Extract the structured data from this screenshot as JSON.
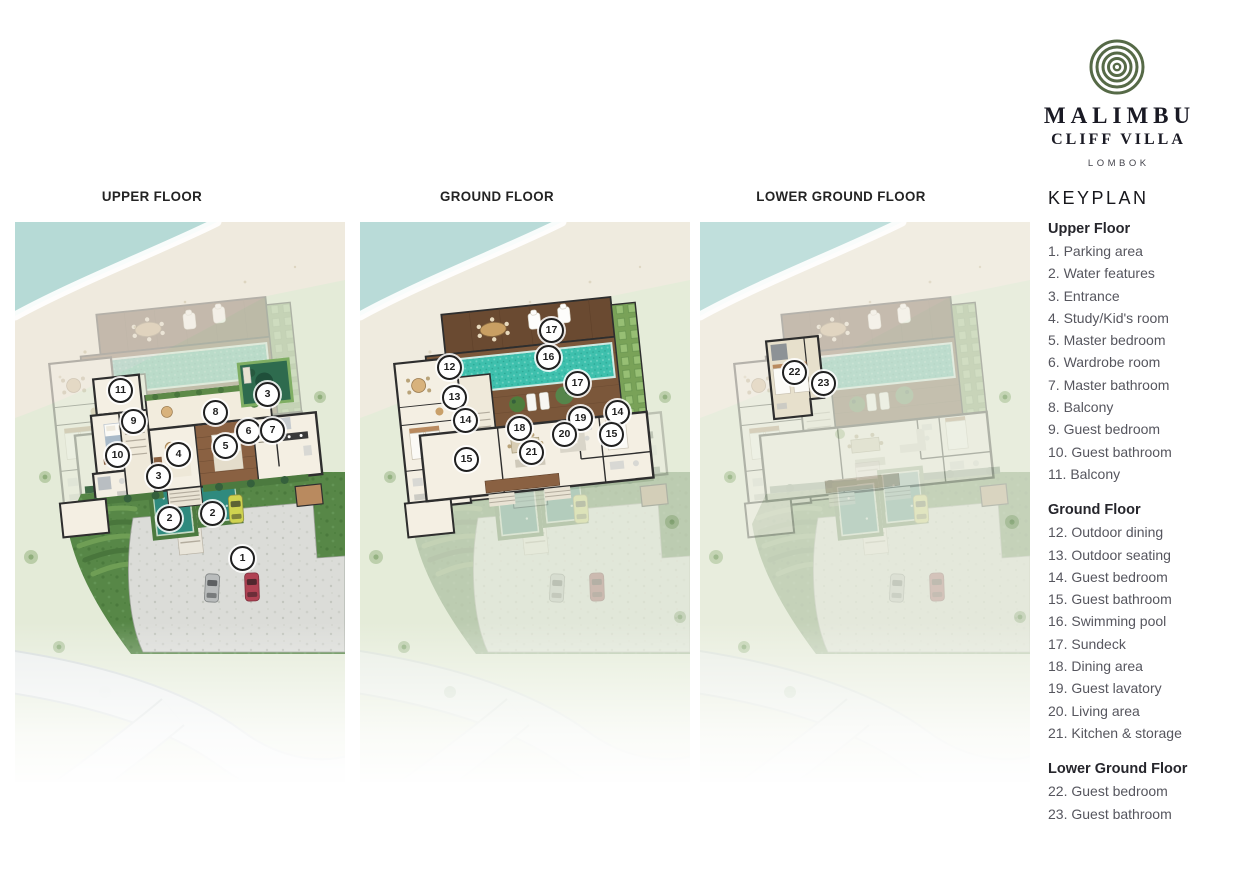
{
  "logo": {
    "name": "MALIMBU",
    "subtitle": "CLIFF VILLA",
    "location": "LOMBOK"
  },
  "panels": [
    {
      "id": "upper-floor",
      "title": "UPPER FLOOR",
      "markers": [
        {
          "number": "11",
          "x": 105,
          "y": 168
        },
        {
          "number": "9",
          "x": 118,
          "y": 199
        },
        {
          "number": "10",
          "x": 102,
          "y": 233
        },
        {
          "number": "3",
          "x": 143,
          "y": 254
        },
        {
          "number": "8",
          "x": 200,
          "y": 190
        },
        {
          "number": "3",
          "x": 252,
          "y": 172
        },
        {
          "number": "4",
          "x": 163,
          "y": 232
        },
        {
          "number": "5",
          "x": 210,
          "y": 224
        },
        {
          "number": "6",
          "x": 233,
          "y": 209
        },
        {
          "number": "7",
          "x": 257,
          "y": 208
        },
        {
          "number": "2",
          "x": 154,
          "y": 296
        },
        {
          "number": "2",
          "x": 197,
          "y": 291
        },
        {
          "number": "1",
          "x": 227,
          "y": 336
        }
      ]
    },
    {
      "id": "ground-floor",
      "title": "GROUND FLOOR",
      "markers": [
        {
          "number": "17",
          "x": 191,
          "y": 108
        },
        {
          "number": "16",
          "x": 188,
          "y": 135
        },
        {
          "number": "17",
          "x": 217,
          "y": 161
        },
        {
          "number": "12",
          "x": 89,
          "y": 145
        },
        {
          "number": "13",
          "x": 94,
          "y": 175
        },
        {
          "number": "14",
          "x": 105,
          "y": 198
        },
        {
          "number": "15",
          "x": 106,
          "y": 237
        },
        {
          "number": "18",
          "x": 159,
          "y": 206
        },
        {
          "number": "19",
          "x": 220,
          "y": 196
        },
        {
          "number": "20",
          "x": 204,
          "y": 212
        },
        {
          "number": "21",
          "x": 171,
          "y": 230
        },
        {
          "number": "14",
          "x": 257,
          "y": 190
        },
        {
          "number": "15",
          "x": 251,
          "y": 212
        }
      ]
    },
    {
      "id": "lower-ground-floor",
      "title": "LOWER GROUND FLOOR",
      "markers": [
        {
          "number": "22",
          "x": 94,
          "y": 150
        },
        {
          "number": "23",
          "x": 123,
          "y": 161
        }
      ]
    }
  ],
  "keyplan": {
    "title": "KEYPLAN",
    "sections": [
      {
        "heading": "Upper Floor",
        "items": [
          {
            "number": "1",
            "label": "Parking area"
          },
          {
            "number": "2",
            "label": "Water features"
          },
          {
            "number": "3",
            "label": "Entrance"
          },
          {
            "number": "4",
            "label": "Study/Kid's room"
          },
          {
            "number": "5",
            "label": "Master bedroom"
          },
          {
            "number": "6",
            "label": "Wardrobe room"
          },
          {
            "number": "7",
            "label": "Master bathroom"
          },
          {
            "number": "8",
            "label": "Balcony"
          },
          {
            "number": "9",
            "label": "Guest bedroom"
          },
          {
            "number": "10",
            "label": "Guest bathroom"
          },
          {
            "number": "11",
            "label": "Balcony"
          }
        ]
      },
      {
        "heading": "Ground Floor",
        "items": [
          {
            "number": "12",
            "label": "Outdoor dining"
          },
          {
            "number": "13",
            "label": "Outdoor seating"
          },
          {
            "number": "14",
            "label": "Guest bedroom"
          },
          {
            "number": "15",
            "label": "Guest bathroom"
          },
          {
            "number": "16",
            "label": "Swimming pool"
          },
          {
            "number": "17",
            "label": "Sundeck"
          },
          {
            "number": "18",
            "label": "Dining area"
          },
          {
            "number": "19",
            "label": "Guest lavatory"
          },
          {
            "number": "20",
            "label": "Living area"
          },
          {
            "number": "21",
            "label": "Kitchen & storage"
          }
        ]
      },
      {
        "heading": "Lower Ground Floor",
        "items": [
          {
            "number": "22",
            "label": "Guest bedroom"
          },
          {
            "number": "23",
            "label": "Guest bathroom"
          }
        ]
      }
    ]
  },
  "colors": {
    "logo_ring": "#566a47",
    "pool_teal": "#3ec0ad",
    "deck_wood": "#7b573a",
    "lawn_green": "#578747",
    "land_pale": "#e4ebd8",
    "water_pale": "#b6dad6",
    "sand": "#efeade",
    "wall_dark": "#2e2e2e",
    "room_cream": "#f4efe3",
    "parking_gray": "#dbdcd8",
    "car_yellow": "#cfd34f",
    "car_red": "#b04253",
    "car_silver": "#b9bcbc"
  }
}
